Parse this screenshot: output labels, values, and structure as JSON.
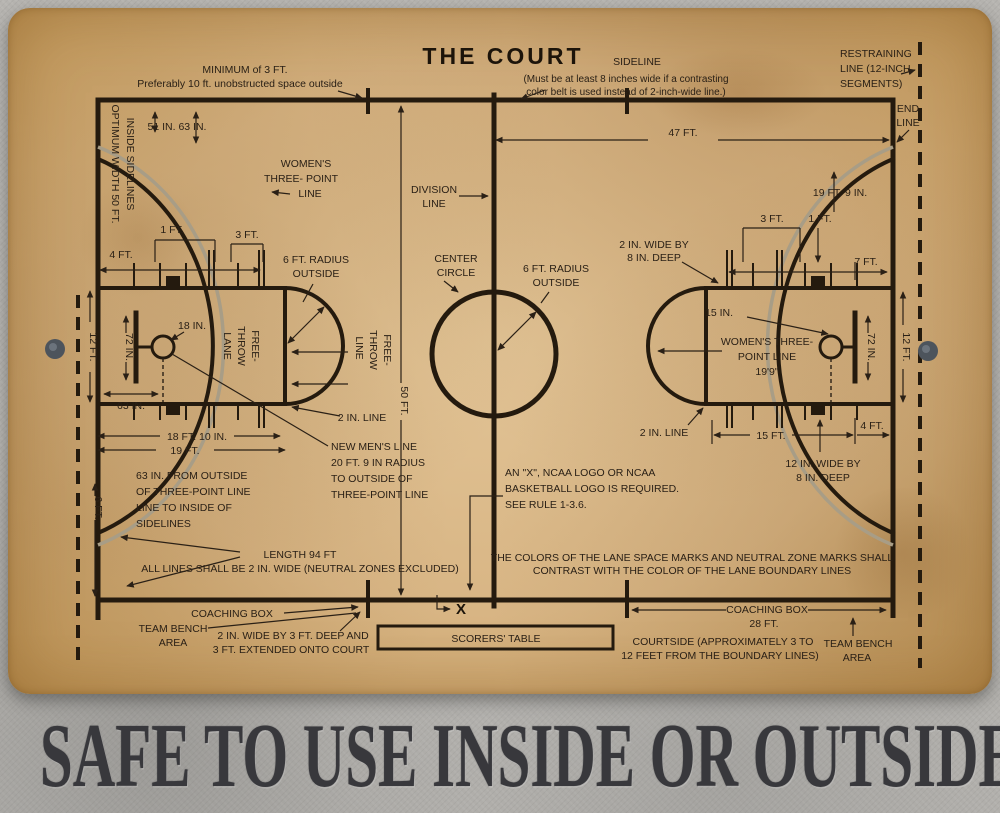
{
  "header": {
    "title": "THE COURT"
  },
  "top": {
    "minimum_line1": "MINIMUM of 3 FT.",
    "minimum_line2": "Preferably 10 ft. unobstructed space outside",
    "sideline_label": "SIDELINE",
    "sideline_note1": "(Must be at least 8 inches wide if a contrasting",
    "sideline_note2": "color belt is used instead of 2-inch-wide line.)",
    "restraining1": "RESTRAINING",
    "restraining2": "LINE (12-INCH",
    "restraining3": "SEGMENTS)",
    "endline1": "END",
    "endline2": "LINE",
    "dim_47": "47 FT."
  },
  "left": {
    "optimum1": "OPTIMUM WIDTH 50 FT.",
    "optimum2": "INSIDE SIDELINES",
    "dim_51_63": "51 IN. 63 IN.",
    "womens1": "WOMEN'S",
    "womens2": "THREE- POINT",
    "womens3": "LINE",
    "dim_1ft": "1 FT.",
    "dim_3ft": "3 FT.",
    "dim_4ft": "4 FT.",
    "radius1": "6 FT. RADIUS",
    "radius2": "OUTSIDE",
    "dim_18in": "18 IN.",
    "dim_72in": "72 IN.",
    "dim_12ft": "12 FT.",
    "dim_63in": "63 IN.",
    "ft_lane1": "FREE-",
    "ft_lane2": "THROW",
    "ft_lane3": "LANE",
    "ft_line1": "FREE-",
    "ft_line2": "THROW",
    "ft_line3": "LINE",
    "dim_2in_line": "2 IN. LINE",
    "dim_18ft10": "18 FT. 10 IN.",
    "dim_19ft": "19 FT.",
    "newmens1": "NEW MEN'S LINE",
    "newmens2": "20 FT. 9 IN RADIUS",
    "newmens3": "TO OUTSIDE OF",
    "newmens4": "THREE-POINT LINE",
    "from63_1": "63 IN. FROM OUTSIDE",
    "from63_2": "OF THREE-POINT LINE",
    "from63_3": "LINE TO INSIDE OF",
    "from63_4": "SIDELINES",
    "dim_6ft": "6 FT."
  },
  "center": {
    "division1": "DIVISION",
    "division2": "LINE",
    "circle1": "CENTER",
    "circle2": "CIRCLE",
    "radius1": "6 FT. RADIUS",
    "radius2": "OUTSIDE",
    "dim_50ft": "50 FT.",
    "ncaa1": "AN \"X\", NCAA LOGO OR NCAA",
    "ncaa2": "BASKETBALL LOGO IS REQUIRED.",
    "ncaa3": "SEE RULE 1-3.6.",
    "length1": "LENGTH 94 FT",
    "length2": "ALL LINES SHALL BE 2 IN. WIDE (NEUTRAL ZONES EXCLUDED)",
    "colors1": "THE COLORS OF THE LANE SPACE MARKS AND NEUTRAL ZONE MARKS SHALL",
    "colors2": "CONTRAST WITH THE COLOR OF THE LANE BOUNDARY LINES",
    "x_mark": "X"
  },
  "right": {
    "dim_19ft9": "19 FT. 9 IN.",
    "dim_3ft": "3 FT.",
    "dim_1ft": "1 FT.",
    "dim_7ft": "7 FT.",
    "wide_2x8_1": "2 IN. WIDE BY",
    "wide_2x8_2": "8 IN. DEEP",
    "dim_15in": "15 IN.",
    "womens1": "WOMEN'S THREE-",
    "womens2": "POINT LINE",
    "womens3": "19'9\"",
    "dim_72in": "72 IN.",
    "dim_12ft": "12 FT.",
    "dim_2in_line": "2 IN. LINE",
    "dim_15ft": "15 FT.",
    "dim_4ft": "4 FT.",
    "wide_12x8_1": "12 IN. WIDE BY",
    "wide_12x8_2": "8 IN. DEEP"
  },
  "bottom": {
    "coaching_left": "COACHING BOX",
    "bench_left1": "TEAM BENCH",
    "bench_left2": "AREA",
    "note_left1": "2 IN. WIDE BY 3 FT. DEEP AND",
    "note_left2": "3 FT. EXTENDED ONTO COURT",
    "scorers": "SCORERS' TABLE",
    "coaching_right": "COACHING BOX",
    "coaching_right_dim": "28 FT.",
    "courtside1": "COURTSIDE (APPROXIMATELY 3 TO",
    "courtside2": "12 FEET FROM THE BOUNDARY LINES)",
    "bench_right1": "TEAM BENCH",
    "bench_right2": "AREA"
  },
  "footer": {
    "slogan": "SAFE TO USE INSIDE OR OUTSIDE."
  },
  "colors": {
    "ink": "#2a2016",
    "parchment": "#d8b584",
    "gray_line": "#a89d86",
    "slogan": "#38383c",
    "concrete": "#b6b4b0"
  }
}
